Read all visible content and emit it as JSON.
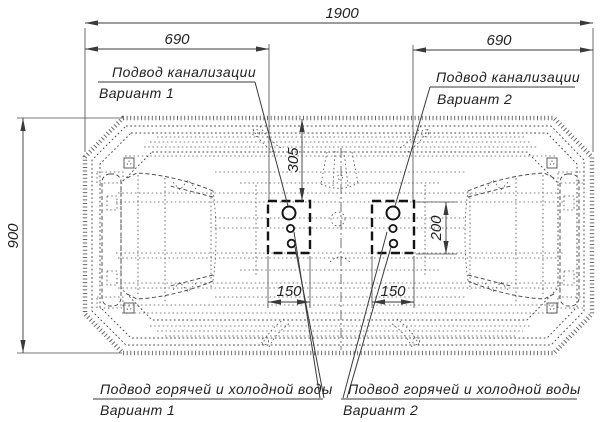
{
  "labels": {
    "sewage_variant1": {
      "line1": "Подвод канализации",
      "line2": "Вариант 1"
    },
    "sewage_variant2": {
      "line1": "Подвод канализации",
      "line2": "Вариант 2"
    },
    "water_variant1": {
      "line1": "Подвод горячей и холодной воды",
      "line2": "Вариант 1"
    },
    "water_variant2": {
      "line1": "Подвод горячей и холодной воды",
      "line2": "Вариант 2"
    }
  },
  "dimensions": {
    "overall_length": "1900",
    "left_sewage_offset": "690",
    "right_sewage_offset": "690",
    "overall_width": "900",
    "connection_zone_top_offset": "305",
    "connection_zone_height": "200",
    "left_connection_zone_width": "150",
    "right_connection_zone_width": "150"
  },
  "colors": {
    "main_line": "#3a3a3a",
    "hidden_line": "#555555",
    "text": "#222222",
    "background": "#ffffff"
  }
}
